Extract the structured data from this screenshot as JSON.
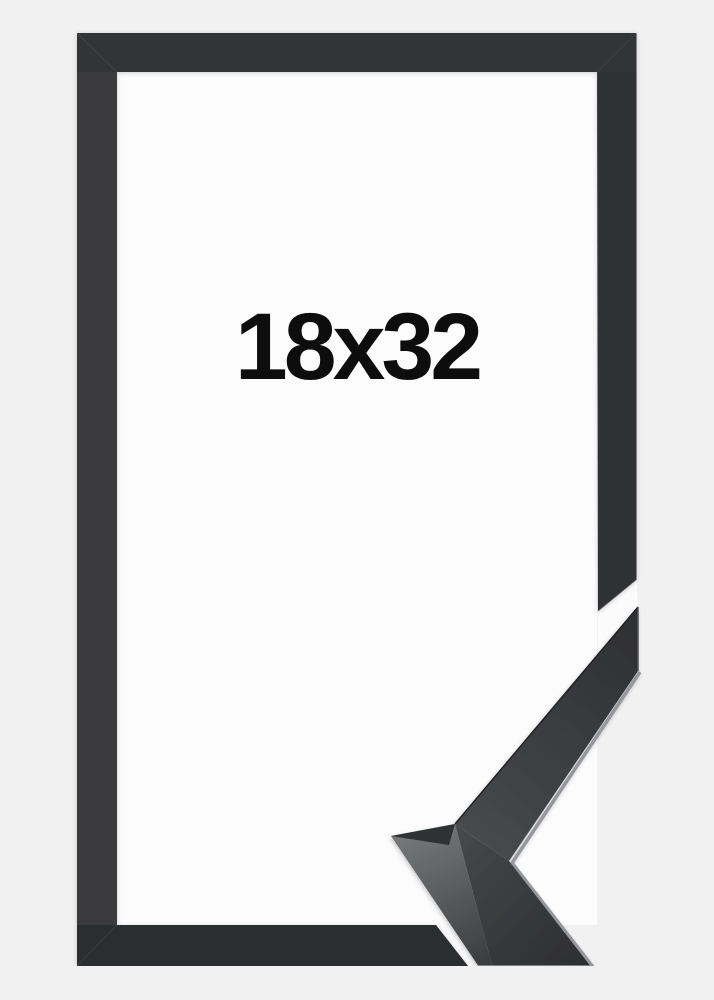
{
  "product": {
    "size_label": "18x32"
  },
  "colors": {
    "background": "#f1f1f2",
    "frame_opening": "#fcfcfd",
    "frame_top_bar": "#323436",
    "frame_left_bar": "#3a3b3d",
    "frame_right_bar": "#2e3032",
    "frame_bottom_bar": "#2b2d2f",
    "cut_gap": "#fbfbfc",
    "sample_top_face_light": "#47494b",
    "sample_top_face_dark": "#2d2f31",
    "sample_lower_face_dark": "#2c2e30",
    "sample_side_light": "#747677",
    "sample_side_dark": "#3a3c3e",
    "sample_corner_facet": "#2f3032",
    "sample_end_cut_edge": "#515355",
    "edge_highlight": "#96979a",
    "outer_edge_shade": "#222325",
    "label_text": "#0d0d0d"
  }
}
